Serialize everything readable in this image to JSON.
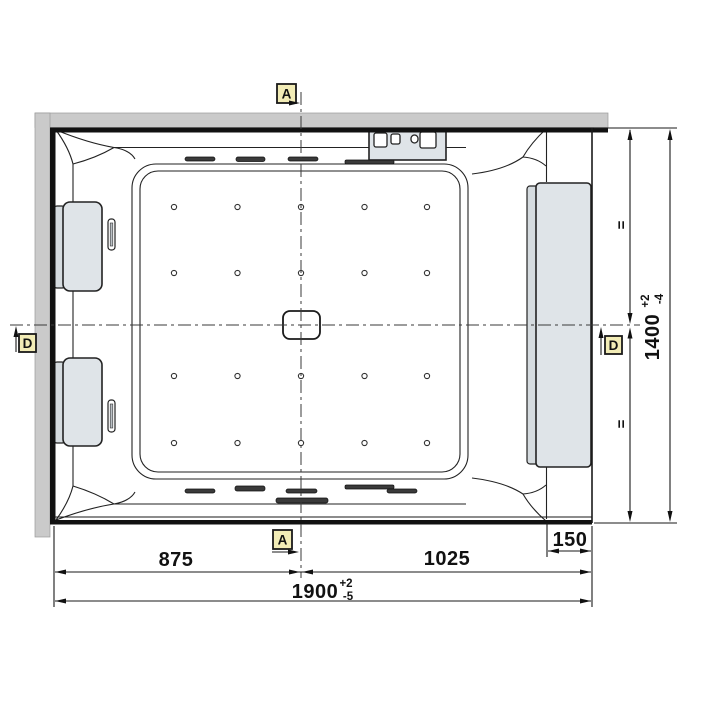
{
  "title": "Whirlpool bathtub installation drawing - plan view",
  "markers": {
    "a_top": {
      "label": "A"
    },
    "a_bottom": {
      "label": "A"
    },
    "d_left": {
      "label": "D"
    },
    "d_right": {
      "label": "D"
    }
  },
  "dimensions": {
    "center_left": "875",
    "center_right": "1025",
    "overall_width": "1900",
    "overall_width_plus": "+2",
    "overall_width_minus": "-5",
    "side_panel": "150",
    "overall_depth": "1400",
    "overall_depth_plus": "+2",
    "overall_depth_minus": "-4",
    "equal_upper": "=",
    "equal_lower": "="
  },
  "colors": {
    "wall": "#cacaca",
    "fixture": "#dfe4e8",
    "fixture2": "#d5dbdf",
    "marker": "#f2ecb6",
    "line": "#1a1a1a"
  },
  "fixtures": {
    "jet_columns": 5,
    "jet_rows": 4,
    "headrests": 2,
    "control_buttons": 4,
    "side_panels": 1,
    "drains": 1
  }
}
